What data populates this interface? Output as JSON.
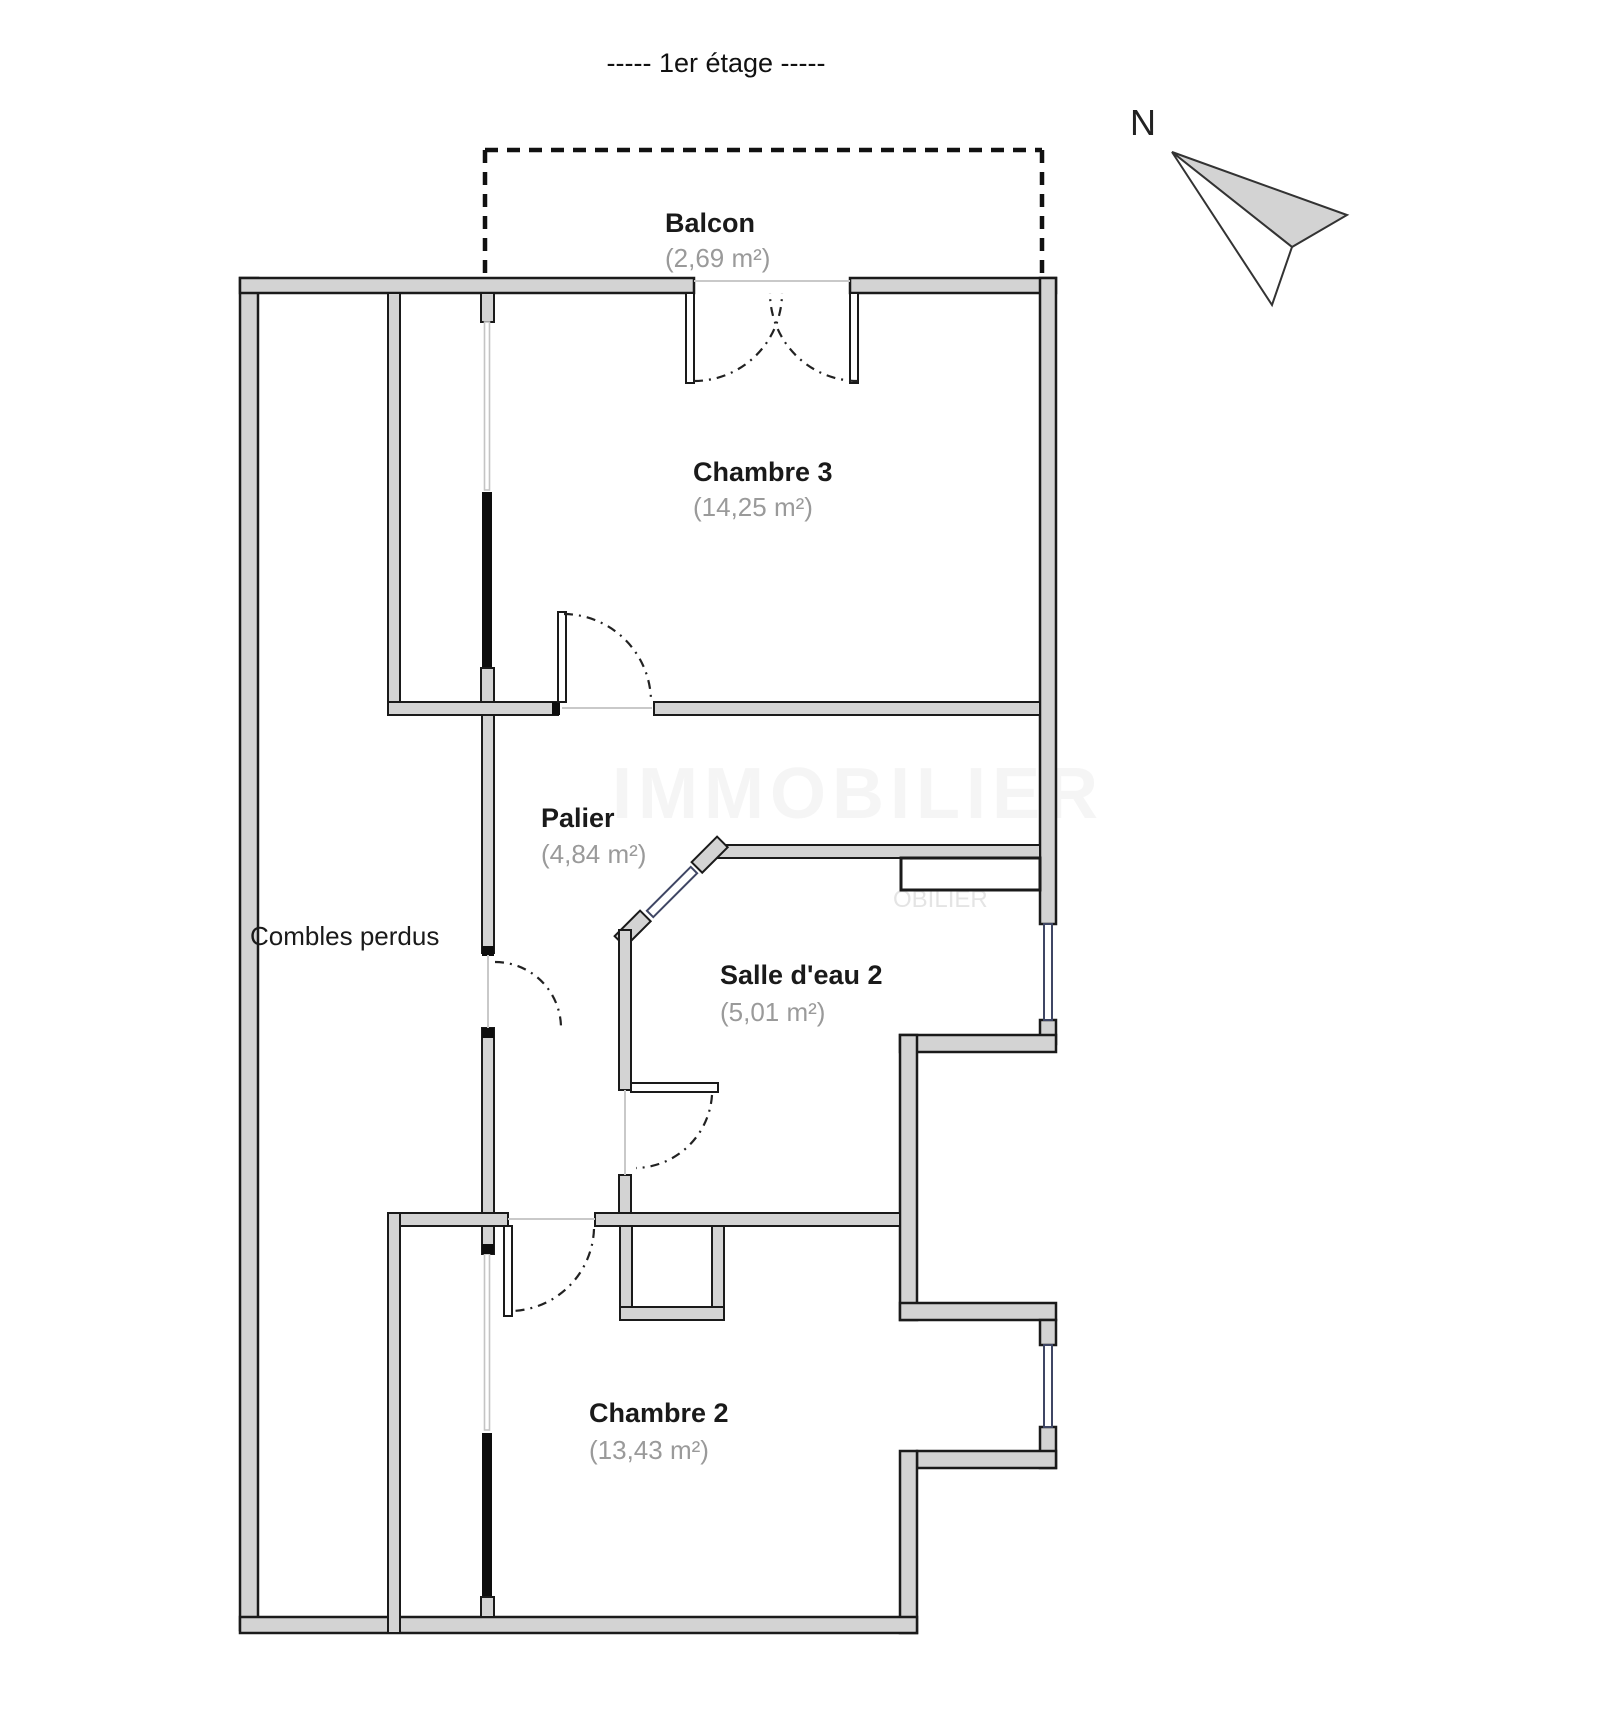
{
  "title": {
    "text": "-----  1er étage  -----"
  },
  "compass": {
    "label": "N"
  },
  "watermark": {
    "large": "IMMOBILIER",
    "small": "OBILIER"
  },
  "colors": {
    "wall_fill": "#d3d3d3",
    "wall_line": "#1a1a1a",
    "room_name_text": "#1a1a1a",
    "room_area_text": "#9a9a9a",
    "window_frame": "#3f4664",
    "glazing_line": "#c4c4c4",
    "solid_black_wall": "#0d0d0d",
    "balcony_dash": "#111111"
  },
  "rooms": [
    {
      "name": "Balcon",
      "area": "(2,69 m²)"
    },
    {
      "name": "Chambre 3",
      "area": "(14,25 m²)"
    },
    {
      "name": "Palier",
      "area": "(4,84 m²)"
    },
    {
      "name": "Combles perdus",
      "area": ""
    },
    {
      "name": "Salle d'eau 2",
      "area": "(5,01 m²)"
    },
    {
      "name": "Chambre 2",
      "area": "(13,43 m²)"
    }
  ]
}
